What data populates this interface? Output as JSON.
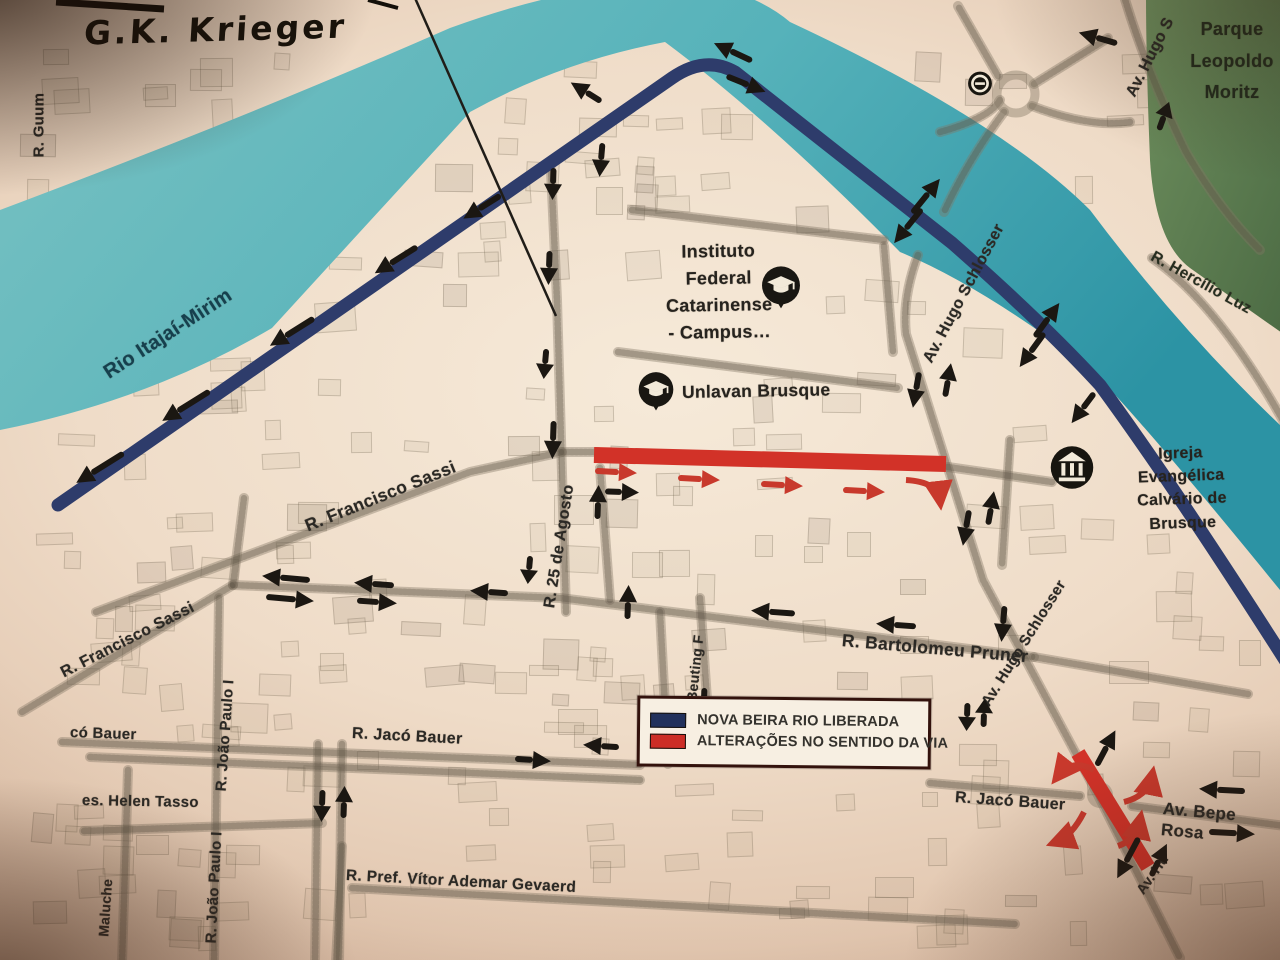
{
  "handwriting": {
    "text": "G.K. Krieger"
  },
  "legend": {
    "items": [
      {
        "label": "NOVA BEIRA RIO LIBERADA",
        "color": "#22315c"
      },
      {
        "label": "ALTERAÇÕES NO SENTIDO DA VIA",
        "color": "#cc2d26"
      }
    ]
  },
  "colors": {
    "river": "#5fb6bd",
    "park": "#64855a",
    "new_road": "#2e3c6b",
    "changed_road": "#d23228",
    "arrow_black": "#1b1712",
    "arrow_red": "#c8392c",
    "paper": "#efdcc8"
  },
  "map": {
    "labels": [
      {
        "id": "street-r-guum",
        "text": "R. Guum",
        "x": 40,
        "y": 148,
        "rot": -90,
        "size": 15
      },
      {
        "id": "river-name",
        "text": "Rio Itajaí-Mirim",
        "x": 106,
        "y": 362,
        "rot": -33,
        "size": 20,
        "color": "#16404e"
      },
      {
        "id": "street-av-hugo-s-top",
        "text": "Av. Hugo S",
        "x": 1131,
        "y": 86,
        "rot": -63,
        "size": 16
      },
      {
        "id": "park-name",
        "lines": [
          "Parque",
          "Leopoldo",
          "Moritz"
        ],
        "x": 1232,
        "y": 14,
        "rot": 0,
        "size": 18,
        "align": "center",
        "lh": 1.75,
        "color": "#222b1d"
      },
      {
        "id": "street-hercilio-luz",
        "text": "R. Hercílio Luz",
        "x": 1152,
        "y": 246,
        "rot": 29,
        "size": 15.5,
        "color": "#272e20"
      },
      {
        "id": "poi-instituto-label",
        "lines": [
          "Instituto",
          "Federal",
          "Catarinense",
          "- Campus…"
        ],
        "x": 718,
        "y": 238,
        "rot": -1,
        "size": 18,
        "align": "center",
        "lh": 1.5,
        "color": "#26231e"
      },
      {
        "id": "poi-unlavan-label",
        "text": "Unlavan Brusque",
        "x": 682,
        "y": 382,
        "rot": -1,
        "size": 17.5,
        "color": "#26231e"
      },
      {
        "id": "poi-igreja-label",
        "lines": [
          "Igreja  Evangélica",
          "Calvário de Brusque"
        ],
        "x": 1180,
        "y": 442,
        "rot": -2,
        "size": 16,
        "align": "center",
        "lh": 1.45,
        "color": "#26231e"
      },
      {
        "id": "street-av-hugo-schlosser-north",
        "text": "Av. Hugo Schlosser",
        "x": 928,
        "y": 352,
        "rot": -62,
        "size": 16
      },
      {
        "id": "street-av-hugo-schlosser-south",
        "text": "Av. Hugo Schlosser",
        "x": 986,
        "y": 696,
        "rot": -58,
        "size": 15
      },
      {
        "id": "street-av-hu",
        "text": "Av. Hu",
        "x": 1140,
        "y": 884,
        "rot": -55,
        "size": 14
      },
      {
        "id": "street-francisco-sassi-upper",
        "text": "R. Francisco Sassi",
        "x": 306,
        "y": 516,
        "rot": -22,
        "size": 17.5
      },
      {
        "id": "street-francisco-sassi-lower",
        "text": "R. Francisco Sassi",
        "x": 62,
        "y": 664,
        "rot": -27,
        "size": 16
      },
      {
        "id": "street-25-de-agosto",
        "text": "R. 25 de Agosto",
        "x": 550,
        "y": 598,
        "rot": -81,
        "size": 16
      },
      {
        "id": "street-joao-beuting",
        "text": "ão Beuting F",
        "x": 690,
        "y": 714,
        "rot": -84,
        "size": 14
      },
      {
        "id": "street-joao-paulo-upper",
        "text": "R. João Paulo I",
        "x": 222,
        "y": 782,
        "rot": -86,
        "size": 15
      },
      {
        "id": "street-joao-paulo-lower",
        "text": "R. João Paulo I",
        "x": 212,
        "y": 934,
        "rot": -87,
        "size": 15
      },
      {
        "id": "street-bartolomeu-pruner",
        "text": "R. Bartolomeu Pruner",
        "x": 842,
        "y": 630,
        "rot": 5,
        "size": 17.5
      },
      {
        "id": "street-jaco-bauer-west",
        "text": "R. Jacó Bauer",
        "x": 352,
        "y": 724,
        "rot": 3,
        "size": 16
      },
      {
        "id": "street-jaco-bauer-east",
        "text": "R. Jacó Bauer",
        "x": 955,
        "y": 788,
        "rot": 4,
        "size": 16
      },
      {
        "id": "street-av-bepe-rosa",
        "text": "Av. Bepe Rosa",
        "x": 1162,
        "y": 798,
        "rot": 5,
        "size": 17
      },
      {
        "id": "street-pref-vitor-ademar-gevaerd",
        "text": "R. Pref. Vítor Ademar Gevaerd",
        "x": 346,
        "y": 866,
        "rot": 3,
        "size": 15.5
      },
      {
        "id": "street-helen-tasso",
        "text": "es. Helen Tasso",
        "x": 82,
        "y": 792,
        "rot": 1,
        "size": 15
      },
      {
        "id": "street-maluche",
        "text": "Maluche",
        "x": 104,
        "y": 928,
        "rot": -86,
        "size": 14
      },
      {
        "id": "street-o-bauer",
        "text": "có Bauer",
        "x": 70,
        "y": 724,
        "rot": 2,
        "size": 15
      }
    ],
    "pois": [
      {
        "id": "instituto-federal-pin",
        "icon": "graduation-cap-icon",
        "x": 781,
        "y": 289,
        "s": 46
      },
      {
        "id": "unlavan-pin",
        "icon": "graduation-cap-icon",
        "x": 656,
        "y": 393,
        "s": 42
      },
      {
        "id": "igreja-pin",
        "icon": "church-icon",
        "x": 1072,
        "y": 470,
        "s": 50
      },
      {
        "id": "station-pin",
        "icon": "transit-icon",
        "x": 980,
        "y": 86,
        "s": 26
      }
    ],
    "arrows": [
      {
        "x": 100,
        "y": 468,
        "rot": 148,
        "len": 56
      },
      {
        "x": 186,
        "y": 406,
        "rot": 148,
        "len": 56
      },
      {
        "x": 292,
        "y": 332,
        "rot": 148,
        "len": 52
      },
      {
        "x": 396,
        "y": 260,
        "rot": 148,
        "len": 50
      },
      {
        "x": 482,
        "y": 207,
        "rot": 148,
        "len": 44
      },
      {
        "x": 733,
        "y": 52,
        "rot": 205,
        "len": 42
      },
      {
        "x": 746,
        "y": 84,
        "rot": 22,
        "len": 42
      },
      {
        "x": 586,
        "y": 92,
        "rot": 212,
        "len": 36
      },
      {
        "x": 601,
        "y": 160,
        "rot": 95,
        "len": 34
      },
      {
        "x": 553,
        "y": 184,
        "rot": 92,
        "len": 32
      },
      {
        "x": 549,
        "y": 268,
        "rot": 92,
        "len": 34
      },
      {
        "x": 545,
        "y": 364,
        "rot": 95,
        "len": 30
      },
      {
        "x": 553,
        "y": 440,
        "rot": 92,
        "len": 38
      },
      {
        "x": 598,
        "y": 502,
        "rot": -88,
        "len": 34
      },
      {
        "x": 622,
        "y": 492,
        "rot": 2,
        "len": 34
      },
      {
        "x": 286,
        "y": 578,
        "rot": 185,
        "len": 48
      },
      {
        "x": 290,
        "y": 599,
        "rot": 5,
        "len": 48
      },
      {
        "x": 374,
        "y": 584,
        "rot": 184,
        "len": 40
      },
      {
        "x": 377,
        "y": 602,
        "rot": 4,
        "len": 40
      },
      {
        "x": 489,
        "y": 592,
        "rot": 184,
        "len": 38
      },
      {
        "x": 529,
        "y": 570,
        "rot": 95,
        "len": 28
      },
      {
        "x": 628,
        "y": 602,
        "rot": -88,
        "len": 34
      },
      {
        "x": 704,
        "y": 700,
        "rot": 92,
        "len": 24
      },
      {
        "x": 773,
        "y": 612,
        "rot": 184,
        "len": 44
      },
      {
        "x": 896,
        "y": 625,
        "rot": 184,
        "len": 40
      },
      {
        "x": 1003,
        "y": 624,
        "rot": 95,
        "len": 36
      },
      {
        "x": 967,
        "y": 717,
        "rot": 92,
        "len": 28
      },
      {
        "x": 984,
        "y": 713,
        "rot": -88,
        "len": 28
      },
      {
        "x": 926,
        "y": 196,
        "rot": -51,
        "len": 44
      },
      {
        "x": 908,
        "y": 226,
        "rot": 129,
        "len": 44
      },
      {
        "x": 1047,
        "y": 320,
        "rot": -54,
        "len": 42
      },
      {
        "x": 1032,
        "y": 350,
        "rot": 126,
        "len": 42
      },
      {
        "x": 1083,
        "y": 408,
        "rot": 127,
        "len": 38
      },
      {
        "x": 916,
        "y": 390,
        "rot": 100,
        "len": 36
      },
      {
        "x": 948,
        "y": 380,
        "rot": -80,
        "len": 34
      },
      {
        "x": 966,
        "y": 528,
        "rot": 100,
        "len": 36
      },
      {
        "x": 991,
        "y": 508,
        "rot": -80,
        "len": 34
      },
      {
        "x": 1106,
        "y": 748,
        "rot": -62,
        "len": 40
      },
      {
        "x": 1128,
        "y": 858,
        "rot": 118,
        "len": 46
      },
      {
        "x": 1159,
        "y": 860,
        "rot": -64,
        "len": 36
      },
      {
        "x": 601,
        "y": 746,
        "rot": 184,
        "len": 36
      },
      {
        "x": 533,
        "y": 760,
        "rot": 4,
        "len": 36
      },
      {
        "x": 322,
        "y": 806,
        "rot": 92,
        "len": 32
      },
      {
        "x": 344,
        "y": 802,
        "rot": -88,
        "len": 32
      },
      {
        "x": 1222,
        "y": 790,
        "rot": 183,
        "len": 46
      },
      {
        "x": 1232,
        "y": 833,
        "rot": 3,
        "len": 46
      },
      {
        "x": 1098,
        "y": 38,
        "rot": 196,
        "len": 40
      },
      {
        "x": 1164,
        "y": 116,
        "rot": -70,
        "len": 30
      },
      {
        "x": 616,
        "y": 472,
        "rot": 3,
        "len": 42,
        "color": "#c8392c"
      },
      {
        "x": 699,
        "y": 479,
        "rot": 3,
        "len": 42,
        "color": "#c8392c"
      },
      {
        "x": 782,
        "y": 485,
        "rot": 3,
        "len": 42,
        "color": "#c8392c"
      },
      {
        "x": 864,
        "y": 491,
        "rot": 3,
        "len": 42,
        "color": "#c8392c"
      }
    ],
    "curved_red_arrows": [
      {
        "path": "M906,480 Q938,482 940,500"
      },
      {
        "path": "M1094,770 Q1072,758 1058,776"
      },
      {
        "path": "M1124,802 Q1148,796 1152,776"
      },
      {
        "path": "M1084,812 Q1072,836 1056,842"
      },
      {
        "path": "M1118,846 Q1136,840 1140,820"
      }
    ]
  }
}
